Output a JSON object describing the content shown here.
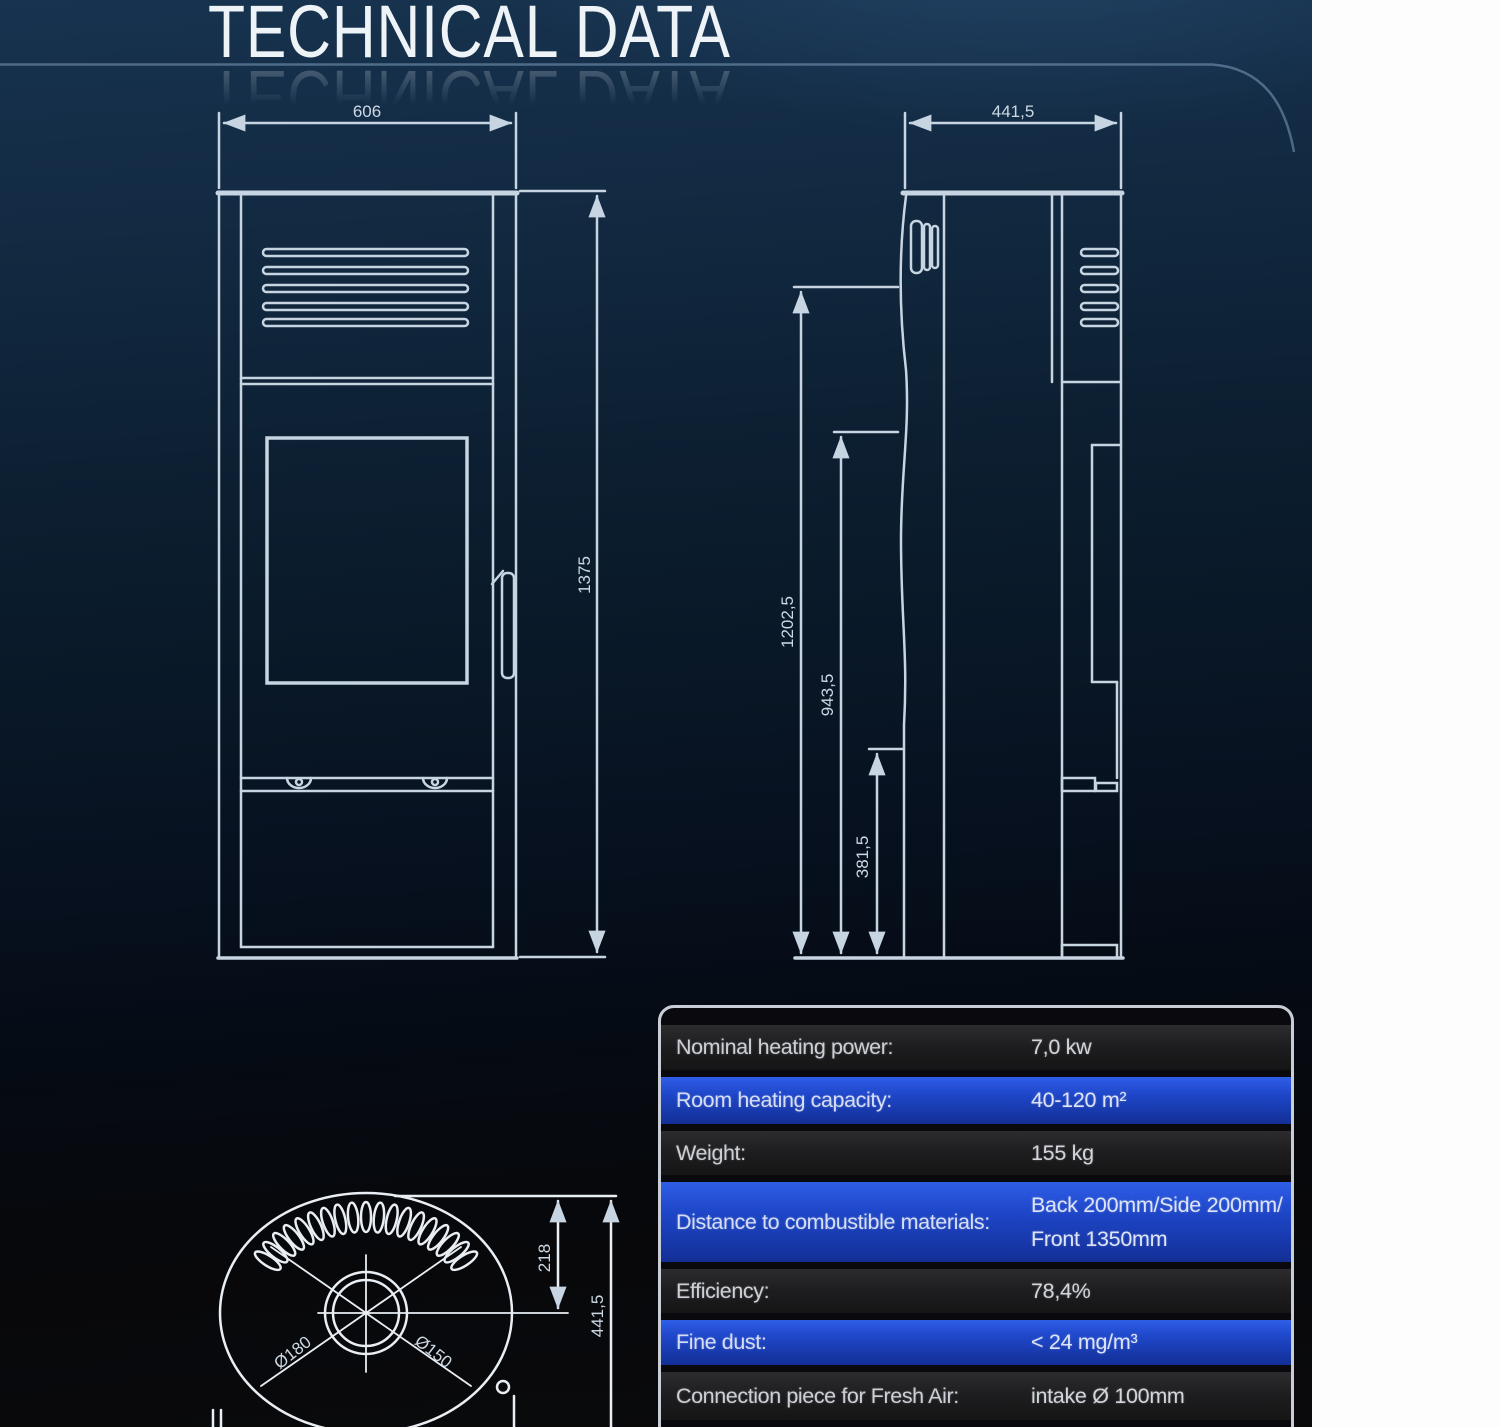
{
  "title": "TECHNICAL DATA",
  "drawings": {
    "front_view": {
      "width_mm": "606",
      "height_mm": "1375"
    },
    "side_view": {
      "depth_mm": "441,5",
      "dim_upper_mm": "1202,5",
      "dim_mid_mm": "943,5",
      "dim_lower_mm": "381,5"
    },
    "top_view": {
      "flue_offset_mm": "218",
      "depth_mm": "441,5",
      "flue_outer_dia": "Ø180",
      "flue_inner_dia": "Ø150"
    }
  },
  "spec_table": {
    "rows": [
      {
        "label": "Nominal heating power:",
        "value": "7,0 kw"
      },
      {
        "label": "Room heating capacity:",
        "value": "40-120 m²"
      },
      {
        "label": "Weight:",
        "value": "155 kg"
      },
      {
        "label": "Distance to combustible materials:",
        "value": "Back 200mm/Side 200mm/",
        "value2": "Front 1350mm"
      },
      {
        "label": "Efficiency:",
        "value": "78,4%"
      },
      {
        "label": "Fine dust:",
        "value": "< 24 mg/m³"
      },
      {
        "label": "Connection piece for Fresh Air:",
        "value": "intake Ø 100mm"
      }
    ]
  },
  "colors": {
    "background_navy": "#122b44",
    "row_blue": "#1e46c8",
    "row_dark": "#1d1d1f",
    "table_border": "#c9ced6",
    "drawing_line": "#c7d5e2",
    "white_strip": "#fdfdfd"
  }
}
